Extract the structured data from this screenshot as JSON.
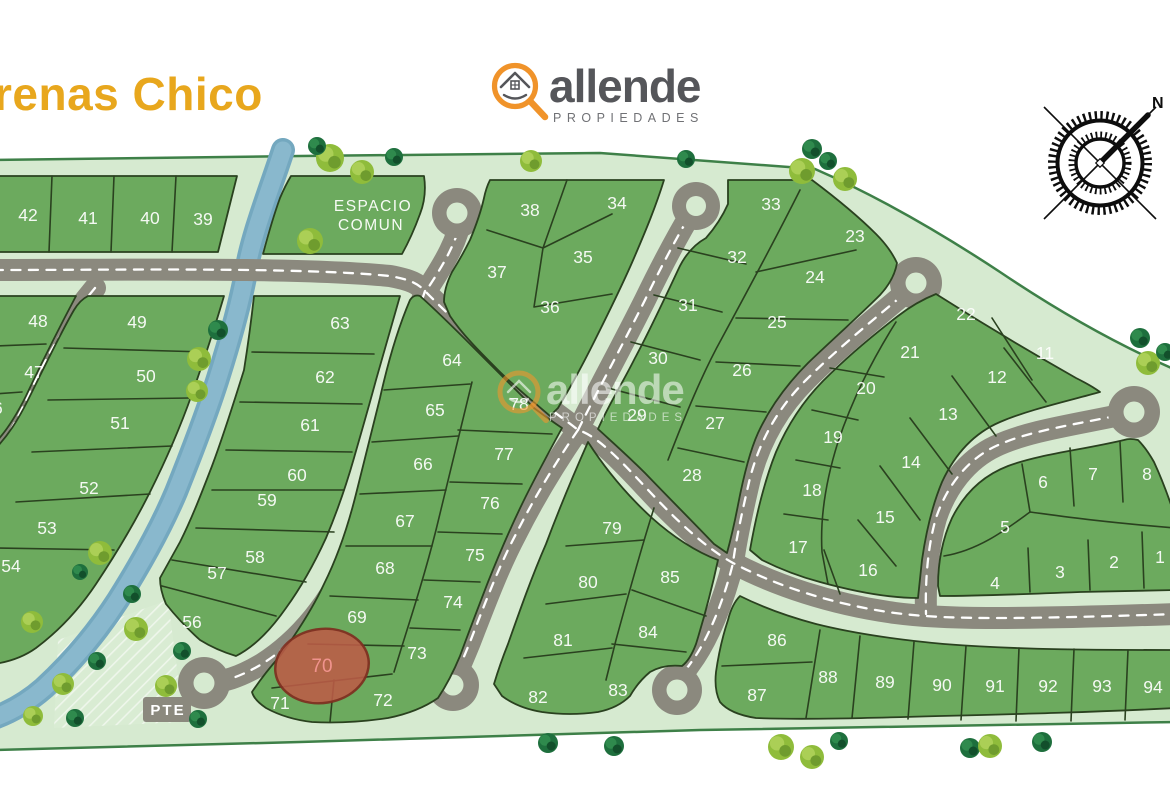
{
  "title": {
    "text": "renas Chico",
    "color": "#E8A71D"
  },
  "logo": {
    "brand": "allende",
    "subtitle": "PROPIEDADES",
    "icon": "magnifier-house",
    "ring_color": "#F0932A",
    "text_color": "#55565A",
    "subtitle_color": "#707175"
  },
  "watermark": {
    "brand": "allende",
    "subtitle": "PROPIEDADES"
  },
  "compass": {
    "north_label": "N"
  },
  "map": {
    "labels": {
      "common_area_line1": "ESPACIO",
      "common_area_line2": "COMUN",
      "bridge": "PTE"
    },
    "highlight": {
      "lot": "70",
      "fill": "#BC5B47",
      "stroke": "#7C2D1F",
      "label_color": "#F0938D"
    },
    "colors": {
      "page": "#FFFFFF",
      "common_green": "#D6EAD0",
      "lot_green": "#6CAA5E",
      "outline": "#2A411F",
      "boundary": "#3E8048",
      "road": "#8B897E",
      "road_dash": "#FFFFFF",
      "river": "#89B8CD",
      "river_edge": "#74A8BF"
    },
    "tree_colors": {
      "light": "#8FBC3B",
      "light_hi": "#ABCF56",
      "light_shade": "#6F9C2E",
      "dark": "#1E6F3D",
      "dark_hi": "#2F8A4D",
      "dark_shade": "#124F2B"
    },
    "lots": [
      {
        "n": "1",
        "x": 1160,
        "y": 557
      },
      {
        "n": "2",
        "x": 1114,
        "y": 562
      },
      {
        "n": "3",
        "x": 1060,
        "y": 572
      },
      {
        "n": "4",
        "x": 995,
        "y": 583
      },
      {
        "n": "5",
        "x": 1005,
        "y": 527
      },
      {
        "n": "6",
        "x": 1043,
        "y": 482
      },
      {
        "n": "7",
        "x": 1093,
        "y": 474
      },
      {
        "n": "8",
        "x": 1147,
        "y": 474
      },
      {
        "n": "11",
        "x": 1045,
        "y": 353
      },
      {
        "n": "12",
        "x": 997,
        "y": 377
      },
      {
        "n": "13",
        "x": 948,
        "y": 414
      },
      {
        "n": "14",
        "x": 911,
        "y": 462
      },
      {
        "n": "15",
        "x": 885,
        "y": 517
      },
      {
        "n": "16",
        "x": 868,
        "y": 570
      },
      {
        "n": "17",
        "x": 798,
        "y": 547
      },
      {
        "n": "18",
        "x": 812,
        "y": 490
      },
      {
        "n": "19",
        "x": 833,
        "y": 437
      },
      {
        "n": "20",
        "x": 866,
        "y": 388
      },
      {
        "n": "21",
        "x": 910,
        "y": 352
      },
      {
        "n": "22",
        "x": 966,
        "y": 314
      },
      {
        "n": "23",
        "x": 855,
        "y": 236
      },
      {
        "n": "24",
        "x": 815,
        "y": 277
      },
      {
        "n": "25",
        "x": 777,
        "y": 322
      },
      {
        "n": "26",
        "x": 742,
        "y": 370
      },
      {
        "n": "27",
        "x": 715,
        "y": 423
      },
      {
        "n": "28",
        "x": 692,
        "y": 475
      },
      {
        "n": "29",
        "x": 637,
        "y": 415
      },
      {
        "n": "30",
        "x": 658,
        "y": 358
      },
      {
        "n": "31",
        "x": 688,
        "y": 305
      },
      {
        "n": "32",
        "x": 737,
        "y": 257
      },
      {
        "n": "33",
        "x": 771,
        "y": 204
      },
      {
        "n": "34",
        "x": 617,
        "y": 203
      },
      {
        "n": "35",
        "x": 583,
        "y": 257
      },
      {
        "n": "36",
        "x": 550,
        "y": 307
      },
      {
        "n": "37",
        "x": 497,
        "y": 272
      },
      {
        "n": "38",
        "x": 530,
        "y": 210
      },
      {
        "n": "39",
        "x": 203,
        "y": 219
      },
      {
        "n": "40",
        "x": 150,
        "y": 218
      },
      {
        "n": "41",
        "x": 88,
        "y": 218
      },
      {
        "n": "42",
        "x": 28,
        "y": 215
      },
      {
        "n": "46",
        "x": -7,
        "y": 408
      },
      {
        "n": "47",
        "x": 34,
        "y": 372
      },
      {
        "n": "48",
        "x": 38,
        "y": 321
      },
      {
        "n": "49",
        "x": 137,
        "y": 322
      },
      {
        "n": "50",
        "x": 146,
        "y": 376
      },
      {
        "n": "51",
        "x": 120,
        "y": 423
      },
      {
        "n": "52",
        "x": 89,
        "y": 488
      },
      {
        "n": "53",
        "x": 47,
        "y": 528
      },
      {
        "n": "54",
        "x": 11,
        "y": 566
      },
      {
        "n": "56",
        "x": 192,
        "y": 622
      },
      {
        "n": "57",
        "x": 217,
        "y": 573
      },
      {
        "n": "58",
        "x": 255,
        "y": 557
      },
      {
        "n": "59",
        "x": 267,
        "y": 500
      },
      {
        "n": "60",
        "x": 297,
        "y": 475
      },
      {
        "n": "61",
        "x": 310,
        "y": 425
      },
      {
        "n": "62",
        "x": 325,
        "y": 377
      },
      {
        "n": "63",
        "x": 340,
        "y": 323
      },
      {
        "n": "64",
        "x": 452,
        "y": 360
      },
      {
        "n": "65",
        "x": 435,
        "y": 410
      },
      {
        "n": "66",
        "x": 423,
        "y": 464
      },
      {
        "n": "67",
        "x": 405,
        "y": 521
      },
      {
        "n": "68",
        "x": 385,
        "y": 568
      },
      {
        "n": "69",
        "x": 357,
        "y": 617
      },
      {
        "n": "70",
        "x": 322,
        "y": 666,
        "highlight": true
      },
      {
        "n": "71",
        "x": 280,
        "y": 703
      },
      {
        "n": "72",
        "x": 383,
        "y": 700
      },
      {
        "n": "73",
        "x": 417,
        "y": 653
      },
      {
        "n": "74",
        "x": 453,
        "y": 602
      },
      {
        "n": "75",
        "x": 475,
        "y": 555
      },
      {
        "n": "76",
        "x": 490,
        "y": 503
      },
      {
        "n": "77",
        "x": 504,
        "y": 454
      },
      {
        "n": "78",
        "x": 519,
        "y": 404
      },
      {
        "n": "79",
        "x": 612,
        "y": 528
      },
      {
        "n": "80",
        "x": 588,
        "y": 582
      },
      {
        "n": "81",
        "x": 563,
        "y": 640
      },
      {
        "n": "82",
        "x": 538,
        "y": 697
      },
      {
        "n": "83",
        "x": 618,
        "y": 690
      },
      {
        "n": "84",
        "x": 648,
        "y": 632
      },
      {
        "n": "85",
        "x": 670,
        "y": 577
      },
      {
        "n": "86",
        "x": 777,
        "y": 640
      },
      {
        "n": "87",
        "x": 757,
        "y": 695
      },
      {
        "n": "88",
        "x": 828,
        "y": 677
      },
      {
        "n": "89",
        "x": 885,
        "y": 682
      },
      {
        "n": "90",
        "x": 942,
        "y": 685
      },
      {
        "n": "91",
        "x": 995,
        "y": 686
      },
      {
        "n": "92",
        "x": 1048,
        "y": 686
      },
      {
        "n": "93",
        "x": 1102,
        "y": 686
      },
      {
        "n": "94",
        "x": 1153,
        "y": 687
      }
    ],
    "trees": [
      {
        "x": 330,
        "y": 158,
        "r": 14,
        "t": "l"
      },
      {
        "x": 317,
        "y": 146,
        "r": 9,
        "t": "d"
      },
      {
        "x": 362,
        "y": 172,
        "r": 12,
        "t": "l"
      },
      {
        "x": 394,
        "y": 157,
        "r": 9,
        "t": "d"
      },
      {
        "x": 310,
        "y": 241,
        "r": 13,
        "t": "l"
      },
      {
        "x": 531,
        "y": 161,
        "r": 11,
        "t": "l"
      },
      {
        "x": 686,
        "y": 159,
        "r": 9,
        "t": "d"
      },
      {
        "x": 812,
        "y": 149,
        "r": 10,
        "t": "d"
      },
      {
        "x": 802,
        "y": 171,
        "r": 13,
        "t": "l"
      },
      {
        "x": 828,
        "y": 161,
        "r": 9,
        "t": "d"
      },
      {
        "x": 845,
        "y": 179,
        "r": 12,
        "t": "l"
      },
      {
        "x": 1140,
        "y": 338,
        "r": 10,
        "t": "d"
      },
      {
        "x": 1148,
        "y": 363,
        "r": 12,
        "t": "l"
      },
      {
        "x": 1165,
        "y": 352,
        "r": 9,
        "t": "d"
      },
      {
        "x": 218,
        "y": 330,
        "r": 10,
        "t": "d"
      },
      {
        "x": 199,
        "y": 359,
        "r": 12,
        "t": "l"
      },
      {
        "x": 197,
        "y": 391,
        "r": 11,
        "t": "l"
      },
      {
        "x": 100,
        "y": 553,
        "r": 12,
        "t": "l"
      },
      {
        "x": 80,
        "y": 572,
        "r": 8,
        "t": "d"
      },
      {
        "x": 32,
        "y": 622,
        "r": 11,
        "t": "l"
      },
      {
        "x": 132,
        "y": 594,
        "r": 9,
        "t": "d"
      },
      {
        "x": 136,
        "y": 629,
        "r": 12,
        "t": "l"
      },
      {
        "x": 97,
        "y": 661,
        "r": 9,
        "t": "d"
      },
      {
        "x": 63,
        "y": 684,
        "r": 11,
        "t": "l"
      },
      {
        "x": 75,
        "y": 718,
        "r": 9,
        "t": "d"
      },
      {
        "x": 33,
        "y": 716,
        "r": 10,
        "t": "l"
      },
      {
        "x": 198,
        "y": 719,
        "r": 9,
        "t": "d"
      },
      {
        "x": 182,
        "y": 651,
        "r": 9,
        "t": "d"
      },
      {
        "x": 166,
        "y": 686,
        "r": 11,
        "t": "l"
      },
      {
        "x": 548,
        "y": 743,
        "r": 10,
        "t": "d"
      },
      {
        "x": 614,
        "y": 746,
        "r": 10,
        "t": "d"
      },
      {
        "x": 781,
        "y": 747,
        "r": 13,
        "t": "l"
      },
      {
        "x": 812,
        "y": 757,
        "r": 12,
        "t": "l"
      },
      {
        "x": 839,
        "y": 741,
        "r": 9,
        "t": "d"
      },
      {
        "x": 970,
        "y": 748,
        "r": 10,
        "t": "d"
      },
      {
        "x": 990,
        "y": 746,
        "r": 12,
        "t": "l"
      },
      {
        "x": 1042,
        "y": 742,
        "r": 10,
        "t": "d"
      }
    ]
  }
}
